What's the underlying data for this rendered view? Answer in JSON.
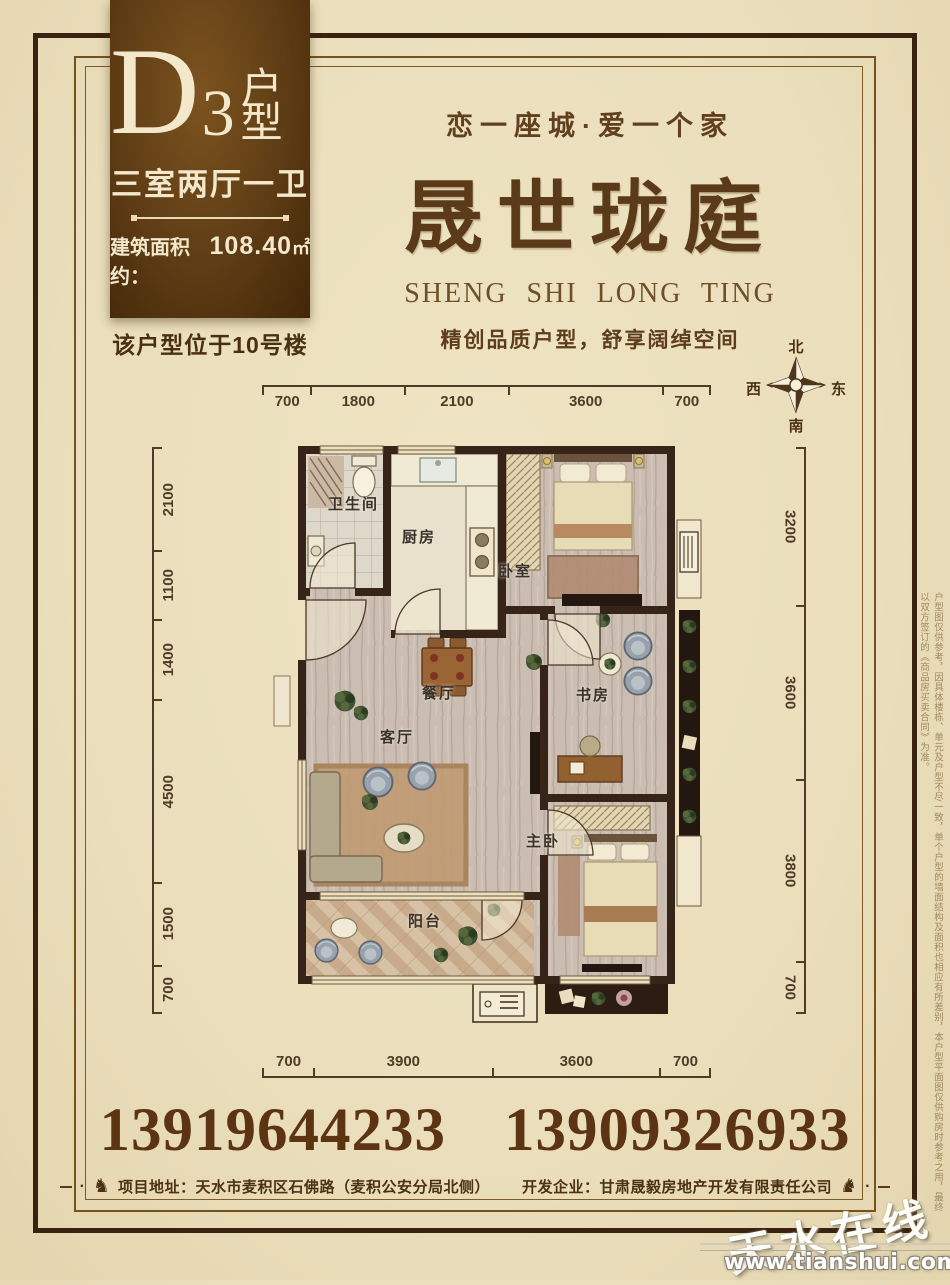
{
  "unit_card": {
    "type_letter": "D",
    "type_number": "3",
    "type_suffix": "户型",
    "layout": "三室两厅一卫",
    "area_label": "建筑面积约：",
    "area_value": "108.40",
    "area_unit": "㎡"
  },
  "location_note": "该户型位于10号楼",
  "brand": {
    "tagline": "恋一座城·爱一个家",
    "name": "晟世珑庭",
    "name_en": "SHENG SHI LONG TING",
    "subtitle": "精创品质户型，舒享阔绰空间"
  },
  "compass": {
    "north": "北",
    "south": "南",
    "east": "东",
    "west": "西"
  },
  "floor_plan": {
    "rooms": [
      "卫生间",
      "厨房",
      "卧室",
      "餐厅",
      "书房",
      "客厅",
      "主卧",
      "阳台"
    ],
    "dims_top": [
      "700",
      "1800",
      "2100",
      "3600",
      "700"
    ],
    "dims_bottom": [
      "700",
      "3900",
      "3600",
      "700"
    ],
    "dims_left": [
      "2100",
      "1100",
      "1400",
      "4500",
      "1500",
      "700"
    ],
    "dims_right": [
      "3200",
      "3600",
      "3800",
      "700"
    ]
  },
  "phones": {
    "first": "13919644233",
    "second": "13909326933"
  },
  "footer": {
    "address_label": "项目地址：",
    "address_value": "天水市麦积区石佛路（麦积公安分局北侧）",
    "developer_label": "开发企业：",
    "developer_value": "甘肃晟毅房地产开发有限责任公司"
  },
  "icons": {
    "horse": "♞",
    "divider_dot": "·"
  },
  "side_note": "户型图仅供参考，因具体楼栋、单元及户型不尽一致，单个户型的墙面结构及面积也相应有所差别，本户型平面图仅供购房时参考之用，最终以双方签订的《商品房买卖合同》为准。",
  "watermark": {
    "site_name": "天水在线",
    "site_url": "www.tianshui.com.cn"
  },
  "colors": {
    "background": "#eadebb",
    "accent_brown": "#5b3a16",
    "card_brown": "#5e3c14",
    "cream": "#f3e8cb",
    "wall": "#362418"
  }
}
